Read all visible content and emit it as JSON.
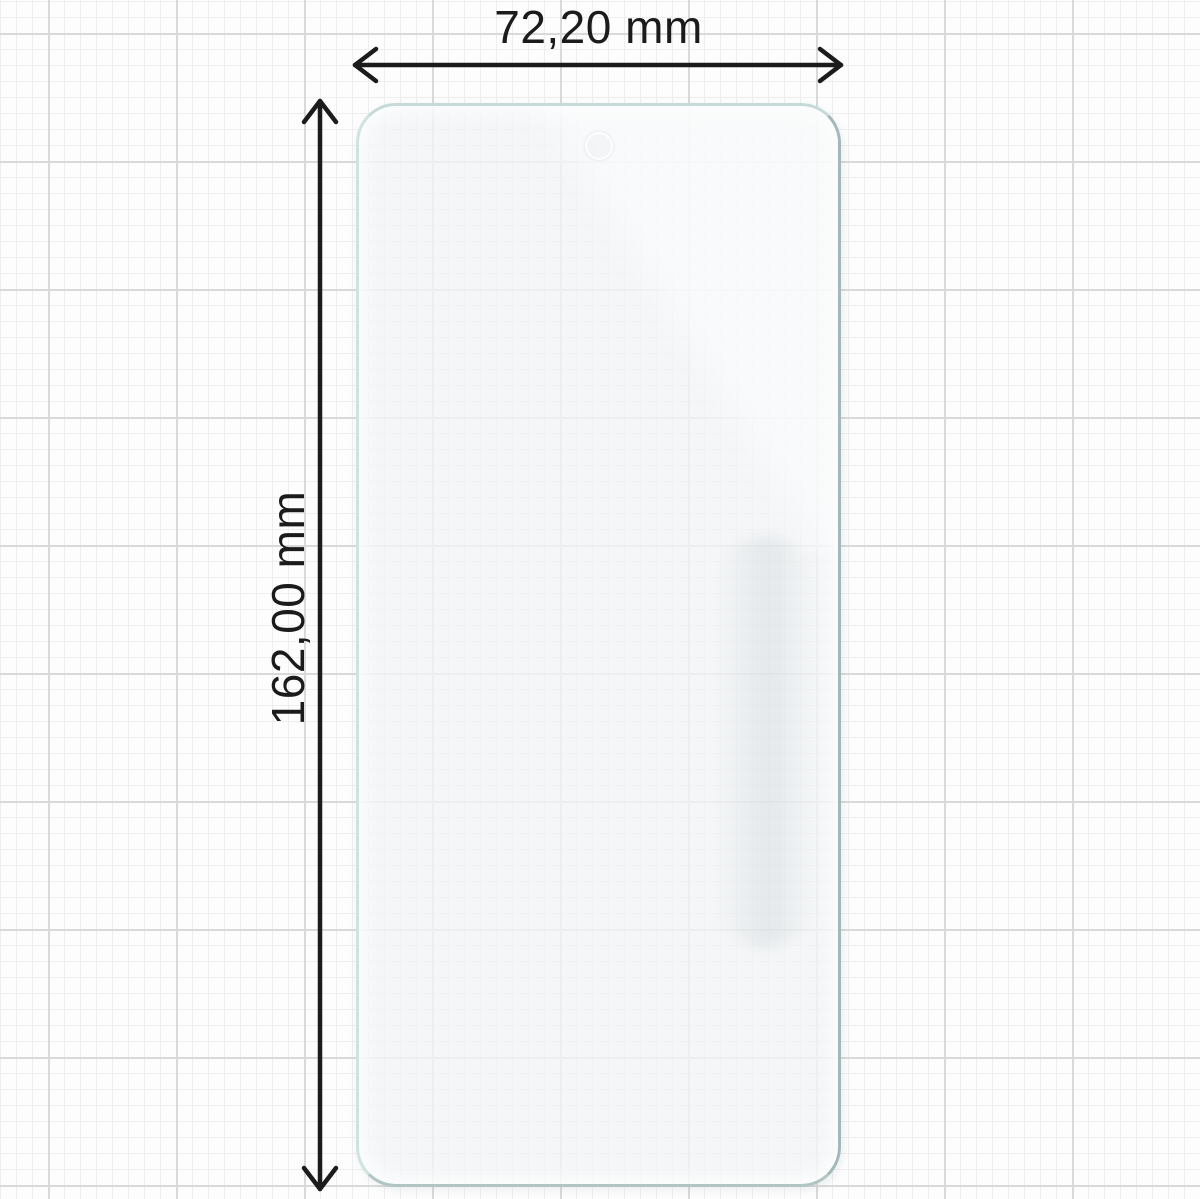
{
  "diagram": {
    "type": "product-dimension-diagram",
    "subject": "phone-screen-protector-film",
    "width_dimension": {
      "label": "72,20 mm"
    },
    "height_dimension": {
      "label": "162,00 mm"
    }
  },
  "colors": {
    "ink": "#1b1b1b",
    "background": "#fdfdfd",
    "grid_minor": "#eeeeee",
    "grid_major": "#d9d9d9",
    "film_fill": "#f1f3f5",
    "film_edge_light": "#cfe4e1",
    "film_edge_dark": "#a3b8ba"
  }
}
